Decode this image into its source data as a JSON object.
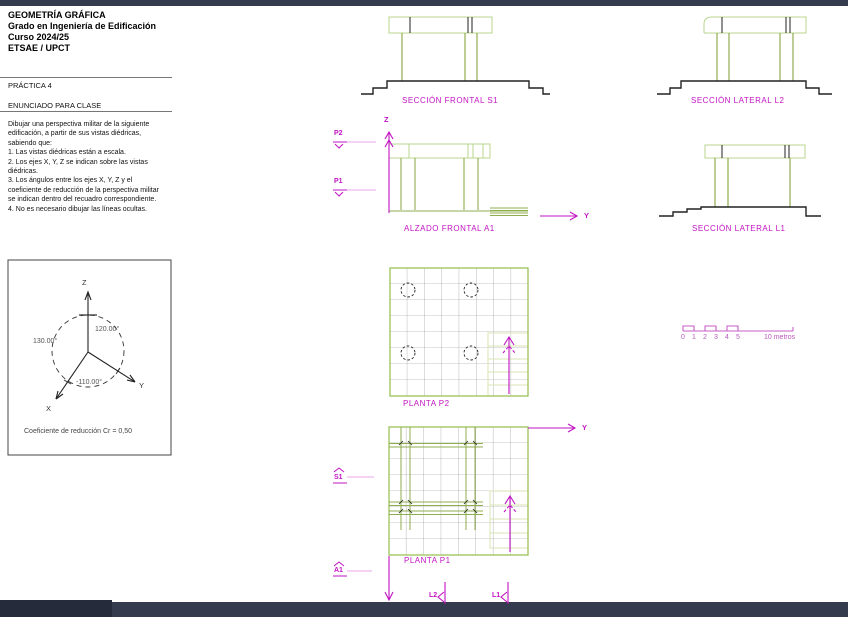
{
  "page": {
    "title_block": "GEOMETRÍA GRÁFICA\nGrado en Ingeniería de Edificación\nCurso 2024/25\nETSAE / UPCT",
    "practice_label": "PRÁCTICA 4",
    "section_label": "ENUNCIADO PARA CLASE",
    "statement": "Dibujar una perspectiva militar de la siguiente\nedificación, a partir de sus vistas diédricas,\nsabiendo que:\n1. Las vistas diédricas están a escala.\n2. Los ejes X, Y, Z se indican sobre las vistas\ndiédricas.\n3. Los ángulos entre los ejes X, Y, Z y el\ncoeficiente de reducción de la perspectiva militar\nse indican dentro del recuadro correspondiente.\n4. No es necesario dibujar las líneas ocultas."
  },
  "axes_box": {
    "angle_left": "130.00°",
    "angle_right": "120.00°",
    "angle_bottom": "-110.00°",
    "coefficient": "Coeficiente de reducción Cr = 0,50"
  },
  "axis_labels": {
    "x": "X",
    "y": "Y",
    "z": "Z"
  },
  "views": {
    "seccion_frontal_s1": "SECCIÓN FRONTAL S1",
    "seccion_lateral_l2": "SECCIÓN LATERAL L2",
    "alzado_frontal_a1": "ALZADO FRONTAL A1",
    "seccion_lateral_l1": "SECCIÓN LATERAL L1",
    "planta_p2": "PLANTA P2",
    "planta_p1": "PLANTA P1"
  },
  "markers": {
    "p2": "P2",
    "p1": "P1",
    "s1": "S1",
    "a1": "A1",
    "l2": "L2",
    "l1": "L1"
  },
  "scale_bar": {
    "ticks": [
      "0",
      "1",
      "2",
      "3",
      "4",
      "5"
    ],
    "end_label": "10 metros"
  },
  "colors": {
    "magenta_label": "#c213c2",
    "pale_magenta": "#e8a7e8",
    "scale_magenta": "#c75fc7",
    "green_line": "#8fae4e",
    "light_green": "#b9d48e",
    "pale_green": "#d9e6b4",
    "dark_line": "#222222",
    "grid_gray": "#8a8a8a",
    "frame_bar": "#343b4c"
  }
}
